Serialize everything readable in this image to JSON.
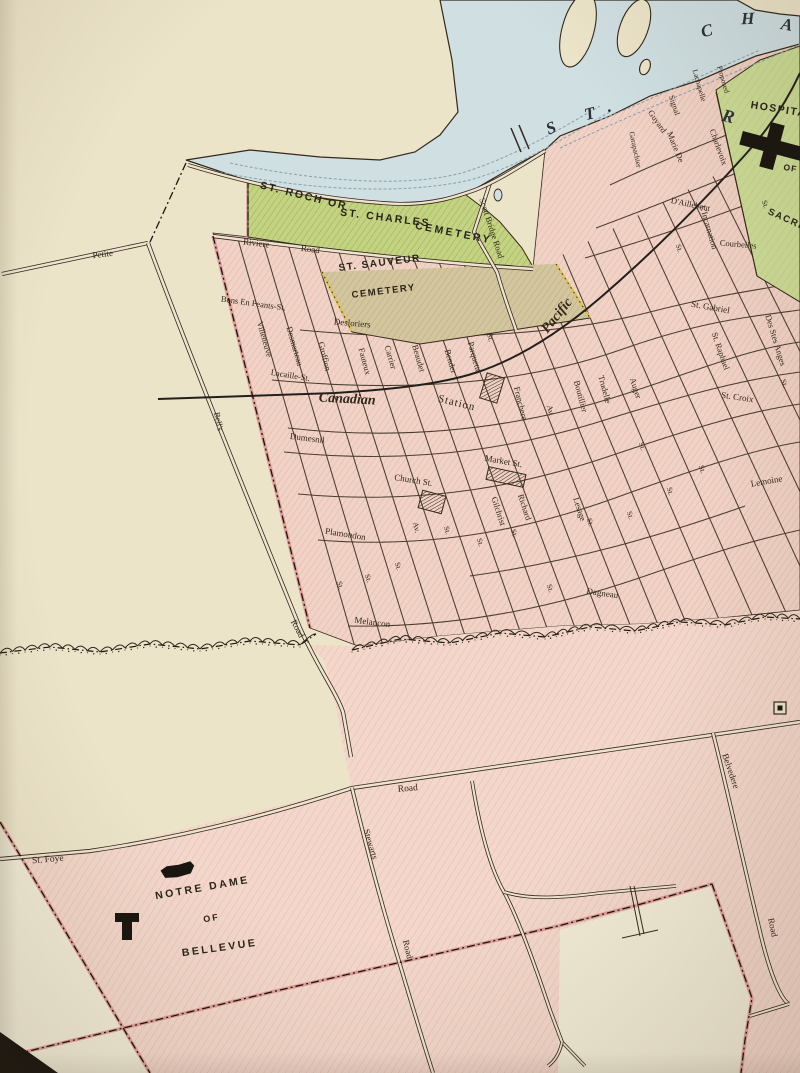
{
  "map": {
    "type": "vintage-city-map",
    "river_letters": [
      {
        "t": "S",
        "x": 553,
        "y": 133,
        "r": -22,
        "s": 17
      },
      {
        "t": "T",
        "x": 591,
        "y": 119,
        "r": -14,
        "s": 17
      },
      {
        "t": ".",
        "x": 610,
        "y": 112,
        "r": 0,
        "s": 17
      },
      {
        "t": "C",
        "x": 708,
        "y": 36,
        "r": -14,
        "s": 17
      },
      {
        "t": "H",
        "x": 748,
        "y": 24,
        "r": -2,
        "s": 17
      },
      {
        "t": "A",
        "x": 786,
        "y": 30,
        "r": 10,
        "s": 17
      },
      {
        "t": "R",
        "x": 727,
        "y": 122,
        "r": 14,
        "s": 18
      }
    ],
    "area_labels": [
      {
        "t": "ST. ROCH OR",
        "x": 303,
        "y": 199,
        "r": 14,
        "s": 10.5,
        "f": "sans",
        "w": 700,
        "ls": 2
      },
      {
        "t": "ST. CHARLES",
        "x": 385,
        "y": 221,
        "r": 7,
        "s": 10.5,
        "f": "sans",
        "w": 700,
        "ls": 2
      },
      {
        "t": "CEMETERY",
        "x": 453,
        "y": 236,
        "r": 11,
        "s": 10.5,
        "f": "sans",
        "w": 700,
        "ls": 2.5
      },
      {
        "t": "ST. SAUVEUR",
        "x": 380,
        "y": 266,
        "r": -7,
        "s": 10,
        "f": "sans",
        "w": 700,
        "ls": 1.5
      },
      {
        "t": "CEMETERY",
        "x": 384,
        "y": 294,
        "r": -7,
        "s": 9.5,
        "f": "sans",
        "w": 700,
        "ls": 1.5
      },
      {
        "t": "HOSPITAL",
        "x": 782,
        "y": 113,
        "r": 9,
        "s": 10.5,
        "f": "sans",
        "w": 700,
        "ls": 1.5
      },
      {
        "t": "OF",
        "x": 790,
        "y": 171,
        "r": 9,
        "s": 8.5,
        "f": "sans",
        "w": 700,
        "ls": 1
      },
      {
        "t": "SACRE",
        "x": 786,
        "y": 222,
        "r": 24,
        "s": 9.5,
        "f": "sans",
        "w": 700,
        "ls": 1.5
      },
      {
        "t": "NOTRE DAME",
        "x": 203,
        "y": 891,
        "r": -10,
        "s": 10.5,
        "f": "sans",
        "w": 700,
        "ls": 2.5
      },
      {
        "t": "OF",
        "x": 212,
        "y": 921,
        "r": -10,
        "s": 9,
        "f": "sans",
        "w": 700,
        "ls": 2
      },
      {
        "t": "BELLEVUE",
        "x": 220,
        "y": 951,
        "r": -8,
        "s": 10.5,
        "f": "sans",
        "w": 700,
        "ls": 2.5
      }
    ],
    "street_labels": [
      {
        "t": "Petite",
        "x": 103,
        "y": 257,
        "r": -7,
        "s": 9
      },
      {
        "t": "Riviere",
        "x": 256,
        "y": 246,
        "r": 7,
        "s": 9
      },
      {
        "t": "Road",
        "x": 310,
        "y": 252,
        "r": 7,
        "s": 9
      },
      {
        "t": "Scott Bridge Road",
        "x": 489,
        "y": 229,
        "r": 72,
        "s": 8.5
      },
      {
        "t": "Bons En Peants-St.",
        "x": 253,
        "y": 306,
        "r": 8,
        "s": 8.5
      },
      {
        "t": "Villeneuve",
        "x": 262,
        "y": 340,
        "r": 74,
        "s": 8.5
      },
      {
        "t": "Desmarteau",
        "x": 292,
        "y": 347,
        "r": 74,
        "s": 8.5
      },
      {
        "t": "Lacaille-St.",
        "x": 290,
        "y": 378,
        "r": 9,
        "s": 8.5
      },
      {
        "t": "Desloriers",
        "x": 352,
        "y": 326,
        "r": 5,
        "s": 9
      },
      {
        "t": "Groffion",
        "x": 322,
        "y": 357,
        "r": 76,
        "s": 8.5
      },
      {
        "t": "Fauteux",
        "x": 362,
        "y": 362,
        "r": 75,
        "s": 8.5
      },
      {
        "t": "Carrier",
        "x": 388,
        "y": 358,
        "r": 74,
        "s": 8.5
      },
      {
        "t": "Beaudet",
        "x": 416,
        "y": 359,
        "r": 74,
        "s": 8.5
      },
      {
        "t": "Bender",
        "x": 448,
        "y": 362,
        "r": 74,
        "s": 8.5
      },
      {
        "t": "Parquette",
        "x": 472,
        "y": 358,
        "r": 75,
        "s": 8.5
      },
      {
        "t": "St.",
        "x": 488,
        "y": 338,
        "r": 75,
        "s": 8
      },
      {
        "t": "Canadian",
        "x": 347,
        "y": 403,
        "r": 3,
        "s": 14,
        "it": 1,
        "w": 700
      },
      {
        "t": "Pacific",
        "x": 560,
        "y": 318,
        "r": -51,
        "s": 14,
        "it": 1,
        "w": 700
      },
      {
        "t": "Station",
        "x": 456,
        "y": 406,
        "r": 14,
        "s": 11,
        "ls": 1
      },
      {
        "t": "Franchere",
        "x": 518,
        "y": 404,
        "r": 76,
        "s": 8.5
      },
      {
        "t": "Av.",
        "x": 548,
        "y": 411,
        "r": 76,
        "s": 8
      },
      {
        "t": "Boutillier",
        "x": 578,
        "y": 397,
        "r": 75,
        "s": 8.5
      },
      {
        "t": "Trudelle",
        "x": 602,
        "y": 390,
        "r": 75,
        "s": 8.5
      },
      {
        "t": "Auger",
        "x": 633,
        "y": 389,
        "r": 72,
        "s": 8.5
      },
      {
        "t": "St. Gabriel",
        "x": 710,
        "y": 310,
        "r": 10,
        "s": 9
      },
      {
        "t": "St. Raphael",
        "x": 718,
        "y": 352,
        "r": 71,
        "s": 8.5
      },
      {
        "t": "Des Stes Anges",
        "x": 773,
        "y": 341,
        "r": 73,
        "s": 8.5
      },
      {
        "t": "St. Croix",
        "x": 737,
        "y": 400,
        "r": 8,
        "s": 9
      },
      {
        "t": "Lemoine",
        "x": 767,
        "y": 484,
        "r": -10,
        "s": 9
      },
      {
        "t": "Dumesnil",
        "x": 307,
        "y": 441,
        "r": 7,
        "s": 9
      },
      {
        "t": "Church St.",
        "x": 413,
        "y": 483,
        "r": 9,
        "s": 9
      },
      {
        "t": "Market St.",
        "x": 503,
        "y": 464,
        "r": 10,
        "s": 9
      },
      {
        "t": "Richard",
        "x": 522,
        "y": 508,
        "r": 72,
        "s": 8.5
      },
      {
        "t": "Gilchrist",
        "x": 496,
        "y": 512,
        "r": 72,
        "s": 8.5
      },
      {
        "t": "Lesage",
        "x": 577,
        "y": 510,
        "r": 72,
        "s": 8.5
      },
      {
        "t": "Av.",
        "x": 414,
        "y": 528,
        "r": 75,
        "s": 8
      },
      {
        "t": "Dagneau",
        "x": 602,
        "y": 596,
        "r": 8,
        "s": 9
      },
      {
        "t": "Plamondon",
        "x": 345,
        "y": 537,
        "r": 9,
        "s": 9
      },
      {
        "t": "Melancon",
        "x": 372,
        "y": 625,
        "r": 7,
        "s": 9
      },
      {
        "t": "Guyard",
        "x": 655,
        "y": 123,
        "r": 55,
        "s": 8.5
      },
      {
        "t": "Garapachier",
        "x": 633,
        "y": 150,
        "r": 78,
        "s": 7.5
      },
      {
        "t": "Signal",
        "x": 672,
        "y": 106,
        "r": 72,
        "s": 8
      },
      {
        "t": "Marie De",
        "x": 673,
        "y": 148,
        "r": 68,
        "s": 8.5
      },
      {
        "t": "L'Incarnation",
        "x": 706,
        "y": 228,
        "r": 74,
        "s": 8.5
      },
      {
        "t": "Charlevoix",
        "x": 716,
        "y": 148,
        "r": 70,
        "s": 8.5
      },
      {
        "t": "D'Aillebout",
        "x": 690,
        "y": 207,
        "r": 12,
        "s": 8.5
      },
      {
        "t": "Courbelles",
        "x": 738,
        "y": 247,
        "r": 5,
        "s": 8.5
      },
      {
        "t": "Lachapelle",
        "x": 697,
        "y": 86,
        "r": 74,
        "s": 7.5
      },
      {
        "t": "Proposed",
        "x": 721,
        "y": 80,
        "r": 74,
        "s": 7.5
      },
      {
        "t": "Bell's",
        "x": 216,
        "y": 422,
        "r": 78,
        "s": 8.5
      },
      {
        "t": "Road",
        "x": 295,
        "y": 630,
        "r": 62,
        "s": 9
      },
      {
        "t": "St. Foye",
        "x": 48,
        "y": 862,
        "r": -5,
        "s": 9.5
      },
      {
        "t": "Road",
        "x": 408,
        "y": 791,
        "r": -5,
        "s": 9.5
      },
      {
        "t": "Stewarts",
        "x": 368,
        "y": 845,
        "r": 73,
        "s": 9
      },
      {
        "t": "Road",
        "x": 405,
        "y": 950,
        "r": 76,
        "s": 9
      },
      {
        "t": "Belvedere",
        "x": 728,
        "y": 772,
        "r": 71,
        "s": 9
      },
      {
        "t": "Road",
        "x": 770,
        "y": 928,
        "r": 78,
        "s": 9
      },
      {
        "t": "St.",
        "x": 338,
        "y": 586,
        "r": 72,
        "s": 7.5
      },
      {
        "t": "St.",
        "x": 366,
        "y": 579,
        "r": 72,
        "s": 7.5
      },
      {
        "t": "St.",
        "x": 396,
        "y": 567,
        "r": 72,
        "s": 7.5
      },
      {
        "t": "St.",
        "x": 445,
        "y": 531,
        "r": 72,
        "s": 7.5
      },
      {
        "t": "St.",
        "x": 478,
        "y": 543,
        "r": 72,
        "s": 7.5
      },
      {
        "t": "St.",
        "x": 512,
        "y": 534,
        "r": 72,
        "s": 7.5
      },
      {
        "t": "St.",
        "x": 548,
        "y": 589,
        "r": 72,
        "s": 7.5
      },
      {
        "t": "St.",
        "x": 588,
        "y": 523,
        "r": 72,
        "s": 7.5
      },
      {
        "t": "St.",
        "x": 628,
        "y": 516,
        "r": 72,
        "s": 7.5
      },
      {
        "t": "St.",
        "x": 668,
        "y": 492,
        "r": 72,
        "s": 7.5
      },
      {
        "t": "St.",
        "x": 700,
        "y": 470,
        "r": 72,
        "s": 7.5
      },
      {
        "t": "St.",
        "x": 782,
        "y": 384,
        "r": 72,
        "s": 7.5
      },
      {
        "t": "St.",
        "x": 763,
        "y": 205,
        "r": 72,
        "s": 7.5
      },
      {
        "t": "St.",
        "x": 677,
        "y": 249,
        "r": 72,
        "s": 7.5
      },
      {
        "t": "St.",
        "x": 640,
        "y": 447,
        "r": 72,
        "s": 7.5
      }
    ],
    "symbols": [
      {
        "name": "hospital-cross",
        "type": "cross",
        "x": 772,
        "y": 146,
        "r": 15
      },
      {
        "name": "station-block",
        "type": "block",
        "x": 492,
        "y": 388,
        "r": 17,
        "w": 18,
        "h": 26
      },
      {
        "name": "church-block",
        "type": "block",
        "x": 432,
        "y": 502,
        "r": 15,
        "w": 24,
        "h": 18
      },
      {
        "name": "market-block",
        "type": "block",
        "x": 506,
        "y": 477,
        "r": 12,
        "w": 38,
        "h": 13
      },
      {
        "name": "building-blob",
        "type": "blob",
        "x": 178,
        "y": 871,
        "r": -12
      },
      {
        "name": "church-building",
        "type": "tshape",
        "x": 127,
        "y": 926,
        "r": 0
      },
      {
        "name": "flag-marker",
        "type": "marker",
        "x": 780,
        "y": 708,
        "r": 0
      },
      {
        "name": "bridge-ticks",
        "type": "ticks",
        "x": 517,
        "y": 138,
        "r": 0
      }
    ],
    "colors": {
      "paper": "#ece4c9",
      "paperLight": "#f0ead4",
      "water": "#cfdfe2",
      "waterLine": "#87a2ae",
      "pink": "#f0d3c6",
      "pinkHatch": "#e3b4a5",
      "pinkSouth": "#f2d7ca",
      "pinkSouthHatch": "#e6bcac",
      "pinkStrip": "#df9f99",
      "green": "#c3d382",
      "greenHatch": "#93a94f",
      "greenHosp": "#cddc97",
      "greenHospHatch": "#b6c878",
      "tan": "#d3c59d",
      "tanHatch": "#b7a67a",
      "ink": "#33291c",
      "rail": "#23201b",
      "label": "#32271a",
      "waterText": "#2d2f3a",
      "yellow": "#d8c455",
      "dark": "#191510"
    }
  }
}
